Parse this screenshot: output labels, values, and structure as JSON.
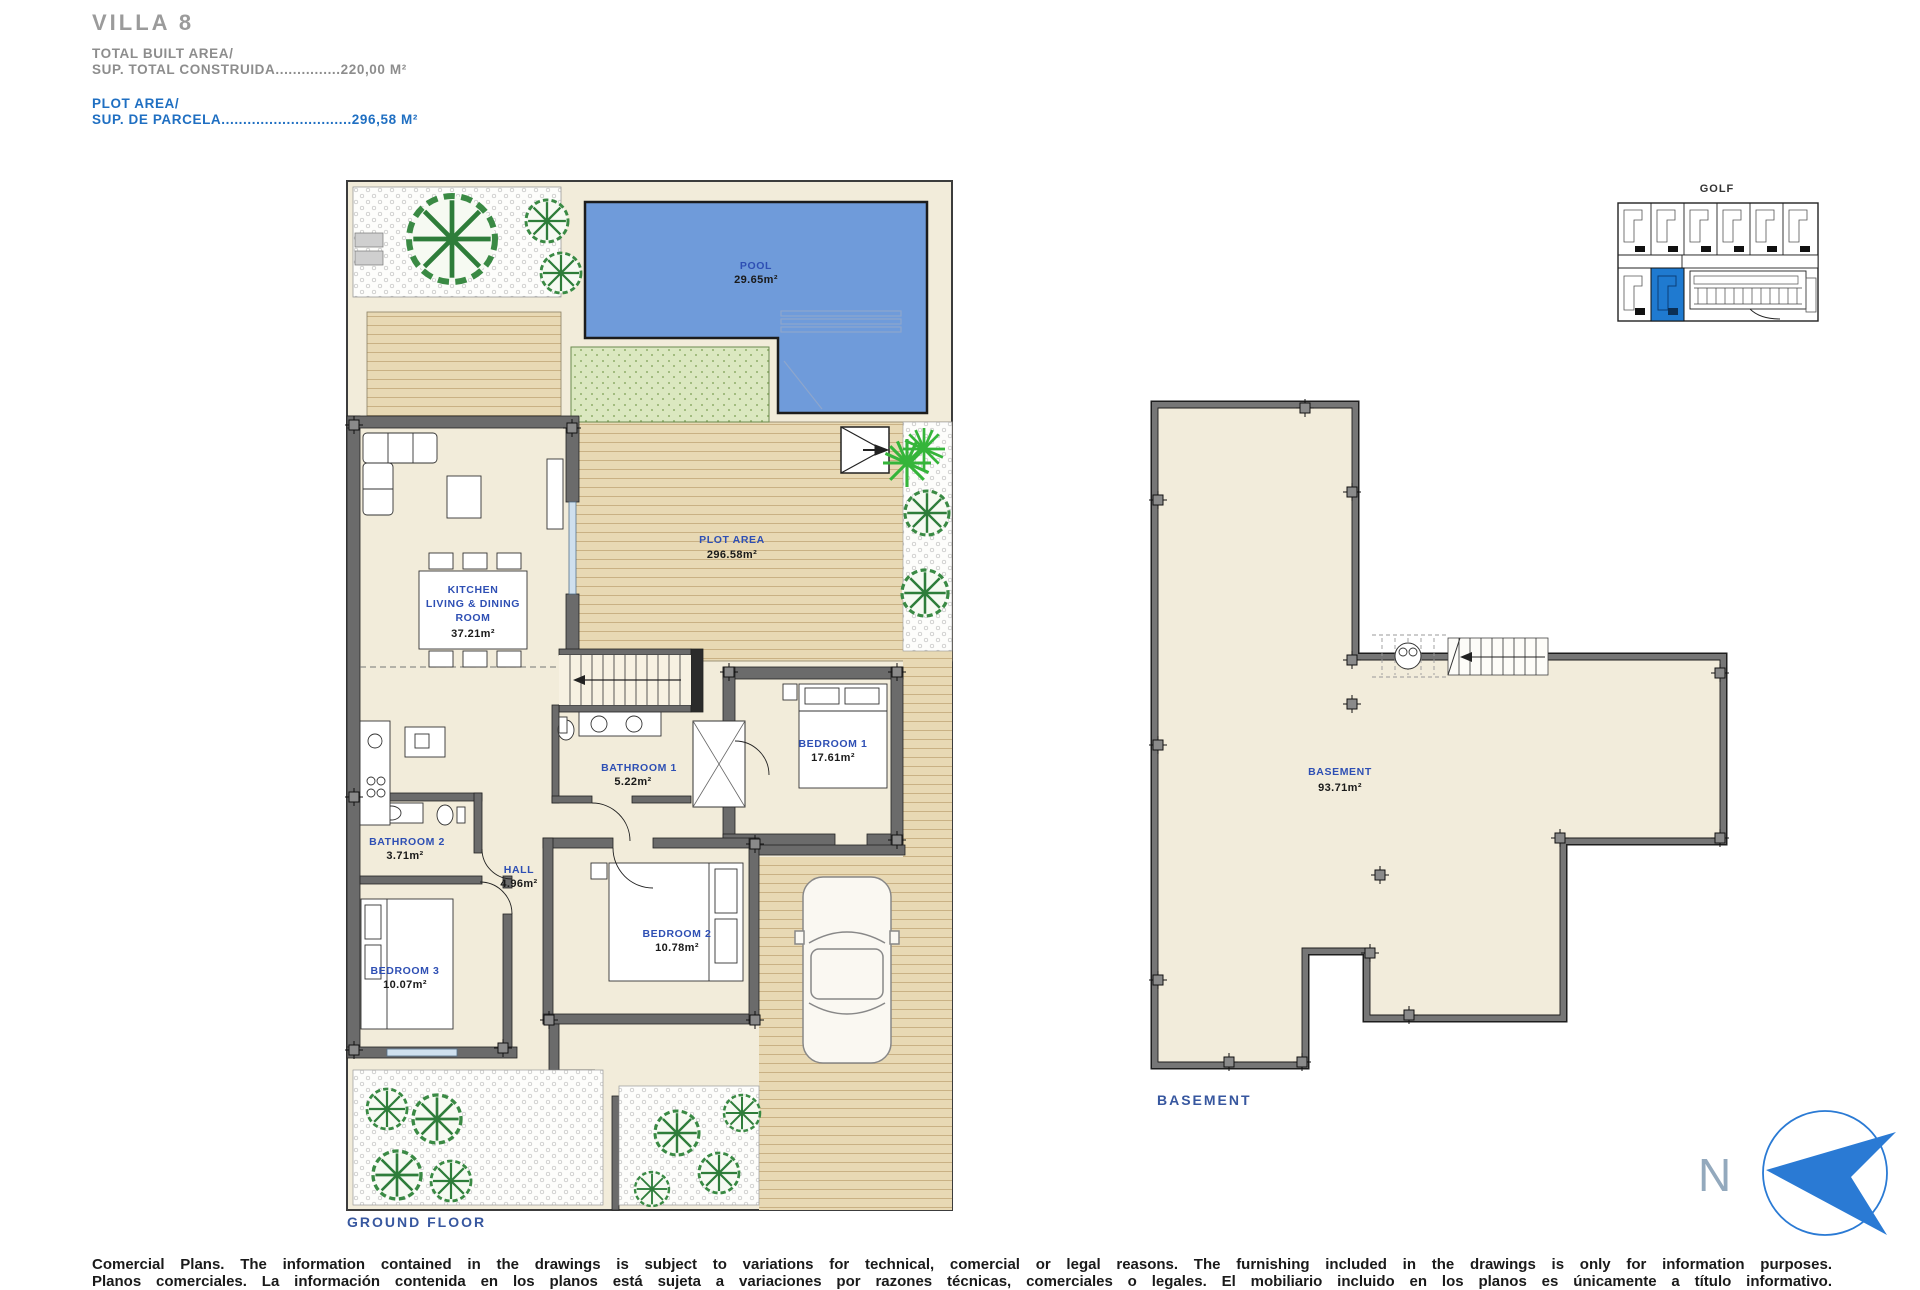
{
  "header": {
    "title": "VILLA 8",
    "built": {
      "l1": "TOTAL BUILT AREA/",
      "l2": "SUP. TOTAL CONSTRUIDA...............220,00 M²"
    },
    "plot": {
      "l1": "PLOT AREA/",
      "l2": "SUP. DE PARCELA..............................296,58 M²"
    }
  },
  "ground": {
    "caption": "GROUND FLOOR",
    "pool": {
      "label": "POOL",
      "area": "29.65m²"
    },
    "plot_area": {
      "label": "PLOT AREA",
      "area": "296.58m²"
    },
    "kitchen": {
      "l1": "KITCHEN",
      "l2": "LIVING & DINING",
      "l3": "ROOM",
      "area": "37.21m²"
    },
    "bathroom1": {
      "label": "BATHROOM 1",
      "area": "5.22m²"
    },
    "bedroom1": {
      "label": "BEDROOM 1",
      "area": "17.61m²"
    },
    "bathroom2": {
      "label": "BATHROOM 2",
      "area": "3.71m²"
    },
    "hall": {
      "label": "HALL",
      "area": "4.96m²"
    },
    "bedroom2": {
      "label": "BEDROOM 2",
      "area": "10.78m²"
    },
    "bedroom3": {
      "label": "BEDROOM 3",
      "area": "10.07m²"
    }
  },
  "basement": {
    "caption": "BASEMENT",
    "room": {
      "label": "BASEMENT",
      "area": "93.71m²"
    }
  },
  "site_plan": {
    "label": "GOLF"
  },
  "compass": {
    "n": "N"
  },
  "footer": {
    "line1": "Comercial Plans. The information contained in the drawings is subject to variations for technical, comercial or legal reasons. The furnishing included in the drawings is only for information purposes.",
    "line2": "Planos comerciales. La información contenida en los planos está sujeta a variaciones por razones técnicas, comerciales o legales. El mobiliario incluido en los planos es únicamente a título informativo."
  },
  "colors": {
    "accent_blue": "#1f7ad0",
    "label_blue": "#2e4fb4",
    "pool_blue": "#6f9bda",
    "wall_gray": "#767676",
    "floor_cream": "#f2ecda",
    "deck_tan": "#e8d9b4",
    "grass_green": "#dbe8c0"
  }
}
